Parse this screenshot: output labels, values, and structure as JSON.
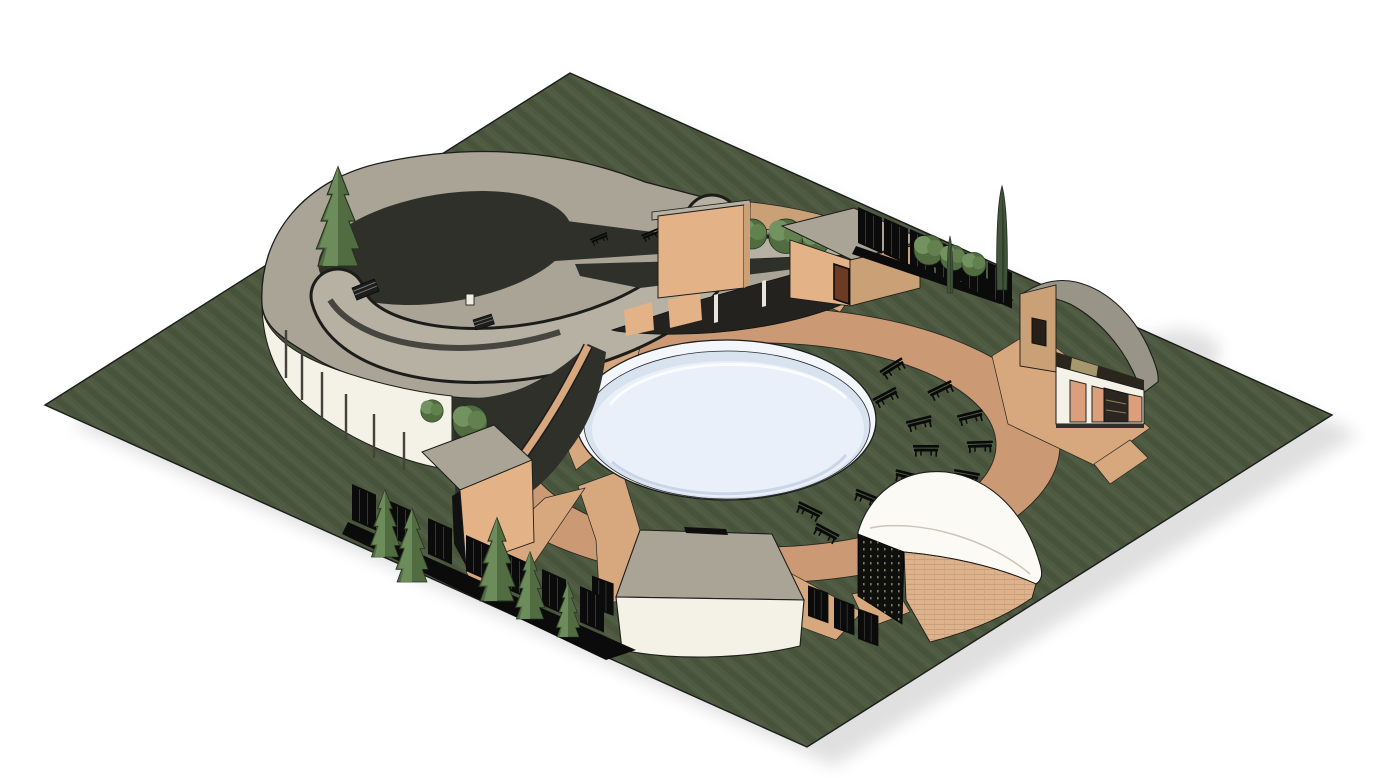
{
  "meta": {
    "type": "isometric-3d-architectural-site-render",
    "background": "#ffffff"
  },
  "colors": {
    "bg": "#ffffff",
    "outline": "#1c1c1a",
    "site_green": "#4e5a41",
    "site_green_dark": "#414c36",
    "path_salmon": "#cb9a75",
    "path_salmon_light": "#d7a77e",
    "pond_rim": "#f3f7fb",
    "pond_mid": "#d9e3f0",
    "pond_water": "#e9f0f9",
    "pond_shadow": "#c7d3e4",
    "roof_gray": "#a9a496",
    "roof_gray_light": "#b6b1a2",
    "roof_fascia": "#474540",
    "wall_white": "#f4f1e6",
    "wall_tan": "#e3b287",
    "wall_tan_shade": "#caa077",
    "door_brown": "#6b3c23",
    "shutter_salmon": "#db9f7b",
    "courtyard_dark": "#30302b",
    "facade_dark": "#23221e",
    "screen_black": "#0f0f0e",
    "bench_black": "#0a0a0a",
    "fence_black": "#0b0b0b",
    "tree_green": "#729260",
    "tree_green_dark": "#516c41",
    "cypress_green": "#42553b",
    "bush_green": "#62814f",
    "shadow_gray": "#e0e0e0",
    "east_roof": "#999488",
    "se_roof_white": "#fbfaf5",
    "se_wall_tan": "#deb28b",
    "frieze_dark": "#2a251d",
    "frieze_khaki": "#a6986c",
    "window_dark": "#262019",
    "glass_dark": "#2c2620"
  },
  "scene": {
    "site": {
      "name": "landscaped-site-plane",
      "material": "grass",
      "shape": "parallelogram"
    },
    "pond": {
      "name": "circular-reflecting-pool"
    },
    "walkways": {
      "name": "circular-walkway-with-radial-paths",
      "radial_segments": 9
    },
    "buildings": [
      {
        "id": "northwest-pavilion",
        "desc": "large round building with crescent roof, roof opening and courtyard conifer"
      },
      {
        "id": "north-screen-wall",
        "desc": "tan wall panel with curved garden wall and trees"
      },
      {
        "id": "northeast-cube",
        "desc": "small flat-roof cube outbuilding with brown door"
      },
      {
        "id": "east-entrance-house",
        "desc": "curved-roof entrance building with shuttered windows and salmon door"
      },
      {
        "id": "southeast-hall",
        "desc": "curved hall, white roof, tan brick wall, perforated dark end wall"
      },
      {
        "id": "south-pavilion",
        "desc": "curved white pavilion with gray fan roof"
      },
      {
        "id": "southwest-kiosk",
        "desc": "small flat-roof kiosk attached to curved white wall"
      }
    ],
    "vegetation": {
      "courtyard_conifer": 1,
      "perimeter_conifers": 5,
      "round_trees": 6,
      "bushes": 3,
      "cypresses": 2
    },
    "furniture": {
      "plaza_benches": 14,
      "courtyard_benches": 2
    },
    "fencing": {
      "rows": 4
    }
  }
}
